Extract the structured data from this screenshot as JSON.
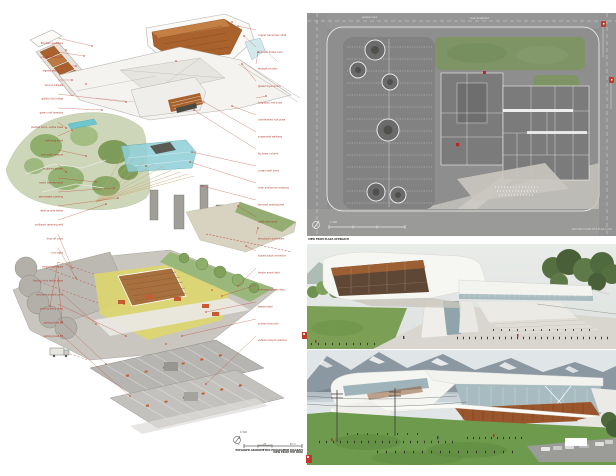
{
  "palette": {
    "annotation_red": "#b03a2e",
    "copper": "#a9622b",
    "teal_glass": "#7ec8d2",
    "plan_gray": "#8e8e8e",
    "lawn_green": "#6f9a4f",
    "mountain_gray": "#8b98a2",
    "plaza_yellow": "#ddd66e",
    "wood_deck": "#a8703f"
  },
  "axon_panel": {
    "title": "exploded axonometric programme diagram",
    "caption": "EXPLODED AXONOMETRIC PROGRAMME DIAGRAM",
    "scale_label": "1:500",
    "scale_ticks": [
      "0",
      "25",
      "50 m"
    ],
    "annotations_left": [
      "fire stair enclosure",
      "precast tread units",
      "egress stair core",
      "service catwalk",
      "gallery link bridge",
      "green roof meadow",
      "planted berm, native trees",
      "reflecting pond",
      "park path network",
      "sculpture garden",
      "event lawn terraces",
      "stormwater planting",
      "retail arcade below",
      "scalloped retaining wall",
      "drop-off court",
      "bus layby",
      "service yard gate",
      "loading dock below plaza",
      "mechanical plant zone",
      "parking entry ramp",
      "parking level B1",
      "parking level B2"
    ],
    "annotations_right": [
      "copper rainscreen shell",
      "acoustic timber liner",
      "skylight monitor",
      "glazed foyer prism",
      "long-span roof truss",
      "cantilevered roof plate",
      "suspended walkway",
      "fly tower volume",
      "curtain wall band",
      "main auditorium massing",
      "terraced seating bowl",
      "cable stay array",
      "structural core towers",
      "sloped plaza connector",
      "timber event deck",
      "pollinator garden strip",
      "feature stair",
      "sunken forecourt",
      "vehicle ramp to parking"
    ]
  },
  "site_panel": {
    "title": "ground floor site plan",
    "street_label_1": "service road",
    "street_label_2": "main boulevard",
    "scale_label": "1:500",
    "caption": "GROUND FLOOR SITE PLAN 1:500"
  },
  "render1": {
    "caption": "VIEW FROM PLAZA APPROACH"
  },
  "render2": {
    "caption": "VIEW FROM THE PARK"
  }
}
